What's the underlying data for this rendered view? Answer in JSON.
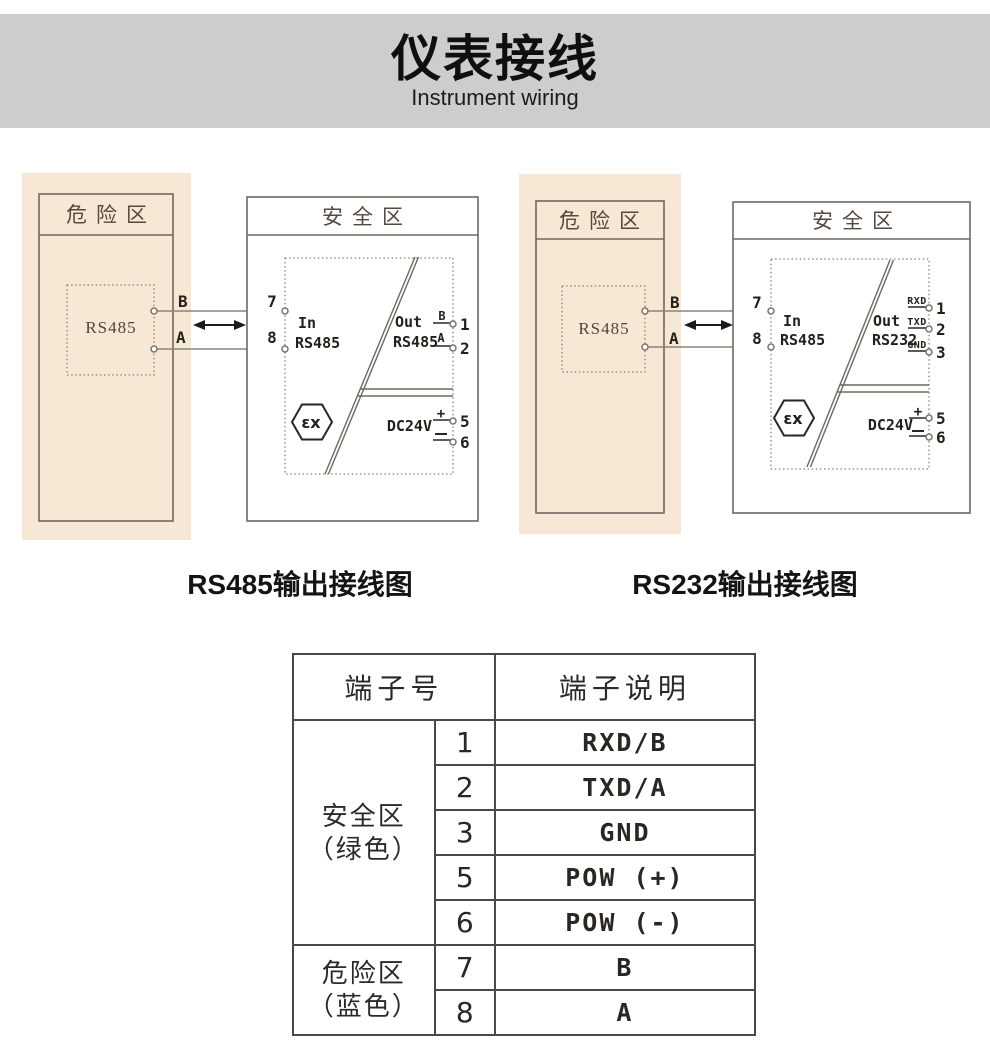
{
  "banner": {
    "title": "仪表接线",
    "subtitle": "Instrument wiring"
  },
  "diagram_rs485": {
    "caption": "RS485输出接线图",
    "danger_label": "危险区",
    "safe_label": "安全区",
    "device": "RS485",
    "wire_b": "B",
    "wire_a": "A",
    "term_7": "7",
    "term_8": "8",
    "in_line1": "In",
    "in_line2": "RS485",
    "out_line1": "Out",
    "out_line2": "RS485",
    "out1_tag": "B",
    "out1_num": "1",
    "out2_tag": "A",
    "out2_num": "2",
    "ex_mark": "εx",
    "power_label": "DC24V",
    "plus": "+",
    "num_5": "5",
    "num_6": "6"
  },
  "diagram_rs232": {
    "caption": "RS232输出接线图",
    "danger_label": "危险区",
    "safe_label": "安全区",
    "device": "RS485",
    "wire_b": "B",
    "wire_a": "A",
    "term_7": "7",
    "term_8": "8",
    "in_line1": "In",
    "in_line2": "RS485",
    "out_line1": "Out",
    "out_line2": "RS232",
    "out1_tag": "RXD",
    "out1_num": "1",
    "out2_tag": "TXD",
    "out2_num": "2",
    "out3_tag": "GND",
    "out3_num": "3",
    "ex_mark": "εx",
    "power_label": "DC24V",
    "plus": "+",
    "num_5": "5",
    "num_6": "6"
  },
  "table": {
    "header_no": "端子号",
    "header_desc": "端子说明",
    "group1": {
      "line1": "安全区",
      "line2": "（绿色）",
      "rows": [
        {
          "no": "1",
          "desc": "RXD/B"
        },
        {
          "no": "2",
          "desc": "TXD/A"
        },
        {
          "no": "3",
          "desc": "GND"
        },
        {
          "no": "5",
          "desc": "POW (+)"
        },
        {
          "no": "6",
          "desc": "POW (-)"
        }
      ]
    },
    "group2": {
      "line1": "危险区",
      "line2": "（蓝色）",
      "rows": [
        {
          "no": "7",
          "desc": "B"
        },
        {
          "no": "8",
          "desc": "A"
        }
      ]
    }
  }
}
